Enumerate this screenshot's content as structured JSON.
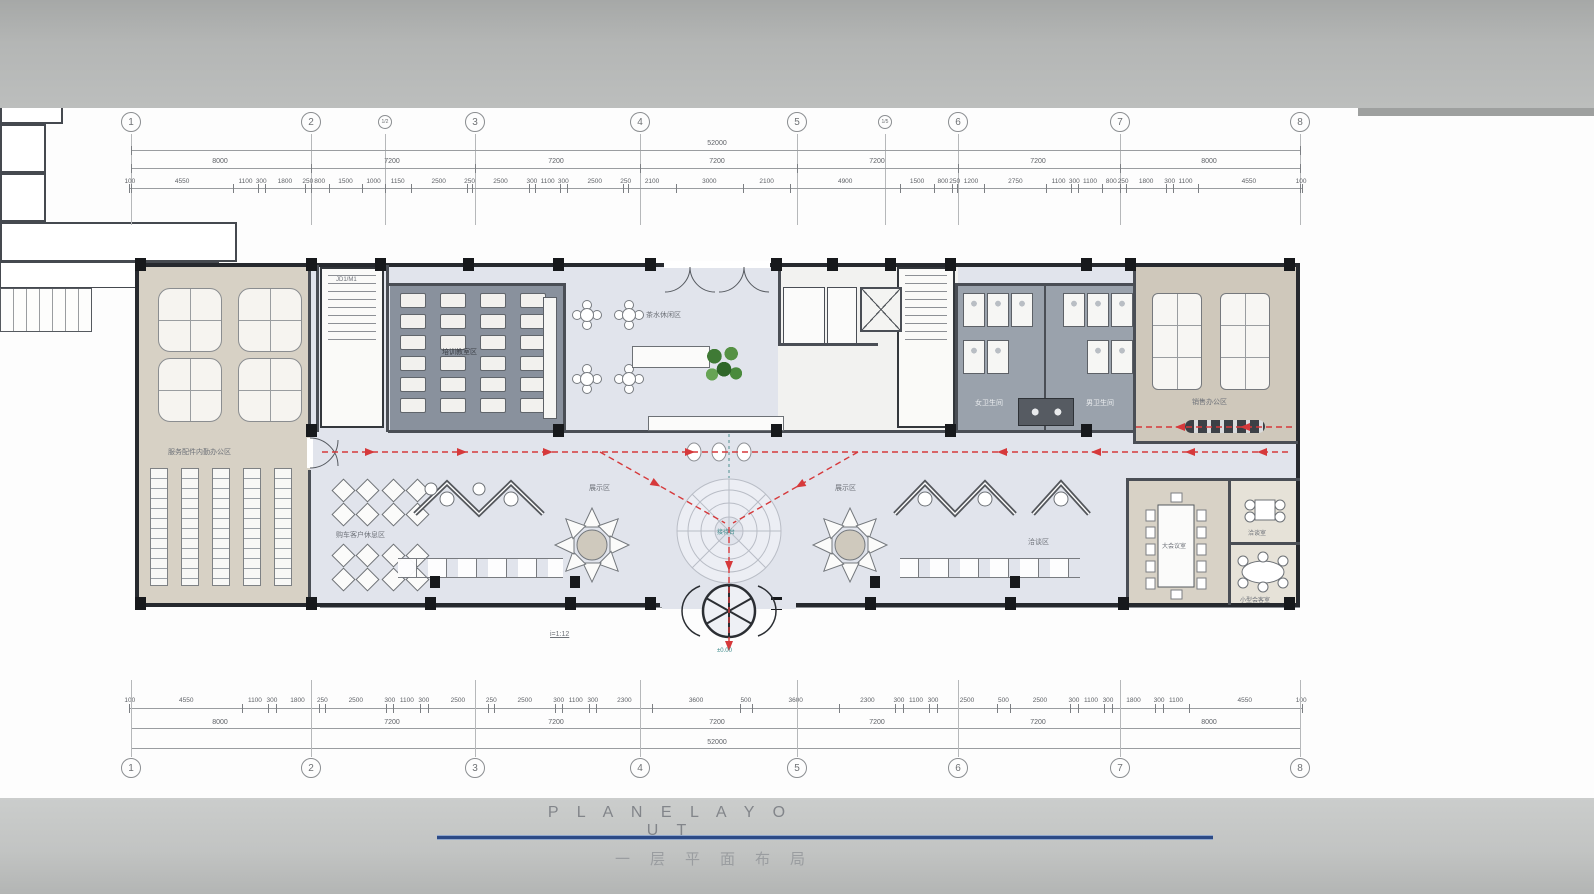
{
  "page": {
    "title_en": "P L A N E   L A Y O U T",
    "title_cn": "一层平面布局",
    "accent_line_color": "#2c4a86",
    "band_color": "#b4b6b5",
    "path_color": "#d6393b"
  },
  "grid": {
    "total": "52000",
    "top_bubbles": [
      {
        "x": 131,
        "l": "1"
      },
      {
        "x": 311,
        "l": "2"
      },
      {
        "x": 385,
        "l": "1/2",
        "sub": true
      },
      {
        "x": 475,
        "l": "3"
      },
      {
        "x": 640,
        "l": "4"
      },
      {
        "x": 797,
        "l": "5"
      },
      {
        "x": 885,
        "l": "1/5",
        "sub": true
      },
      {
        "x": 958,
        "l": "6"
      },
      {
        "x": 1120,
        "l": "7"
      },
      {
        "x": 1300,
        "l": "8"
      }
    ],
    "bottom_bubbles": [
      {
        "x": 131,
        "l": "1"
      },
      {
        "x": 311,
        "l": "2"
      },
      {
        "x": 475,
        "l": "3"
      },
      {
        "x": 640,
        "l": "4"
      },
      {
        "x": 797,
        "l": "5"
      },
      {
        "x": 958,
        "l": "6"
      },
      {
        "x": 1120,
        "l": "7"
      },
      {
        "x": 1300,
        "l": "8"
      }
    ],
    "top_bays": [
      {
        "x": 221,
        "v": "8000"
      },
      {
        "x": 393,
        "v": "7200"
      },
      {
        "x": 557,
        "v": "7200"
      },
      {
        "x": 718,
        "v": "7200"
      },
      {
        "x": 878,
        "v": "7200"
      },
      {
        "x": 1039,
        "v": "7200"
      },
      {
        "x": 1210,
        "v": "8000"
      }
    ],
    "bottom_bays": [
      {
        "x": 221,
        "v": "8000"
      },
      {
        "x": 393,
        "v": "7200"
      },
      {
        "x": 557,
        "v": "7200"
      },
      {
        "x": 718,
        "v": "7200"
      },
      {
        "x": 878,
        "v": "7200"
      },
      {
        "x": 1039,
        "v": "7200"
      },
      {
        "x": 1210,
        "v": "8000"
      }
    ],
    "top_chain": [
      100,
      4550,
      1100,
      300,
      1800,
      250,
      800,
      1500,
      1000,
      1150,
      2500,
      250,
      2500,
      300,
      1100,
      300,
      2500,
      250,
      2100,
      3000,
      2100,
      4900,
      1500,
      800,
      250,
      1200,
      2750,
      1100,
      300,
      1100,
      800,
      250,
      1800,
      300,
      1100,
      4550,
      100
    ],
    "bottom_chain": [
      100,
      4550,
      1100,
      300,
      1800,
      250,
      2500,
      300,
      1100,
      300,
      2500,
      250,
      2500,
      300,
      1100,
      300,
      2300,
      3600,
      500,
      3600,
      2300,
      300,
      1100,
      300,
      2500,
      500,
      2500,
      300,
      1100,
      300,
      1800,
      300,
      1100,
      4550,
      100
    ]
  },
  "rooms": {
    "left_office": "服务配件内勤办公区",
    "training": "培训教室区",
    "tea": "茶水休闲区",
    "toilet_women": "女卫生间",
    "toilet_men": "男卫生间",
    "sales_office": "销售办公区",
    "rest_area": "购车客户休息区",
    "display_left": "展示区",
    "display_right": "展示区",
    "negotiation": "洽谈区",
    "meeting_room": "大会议室",
    "reception_room": "洽谈室",
    "small_meeting": "小型会客室"
  },
  "annotations": {
    "ramp_slope": "i=1:12",
    "entry_level": "±0.00",
    "center_feature": "接待台",
    "stair_tag": "JD1/M1"
  }
}
